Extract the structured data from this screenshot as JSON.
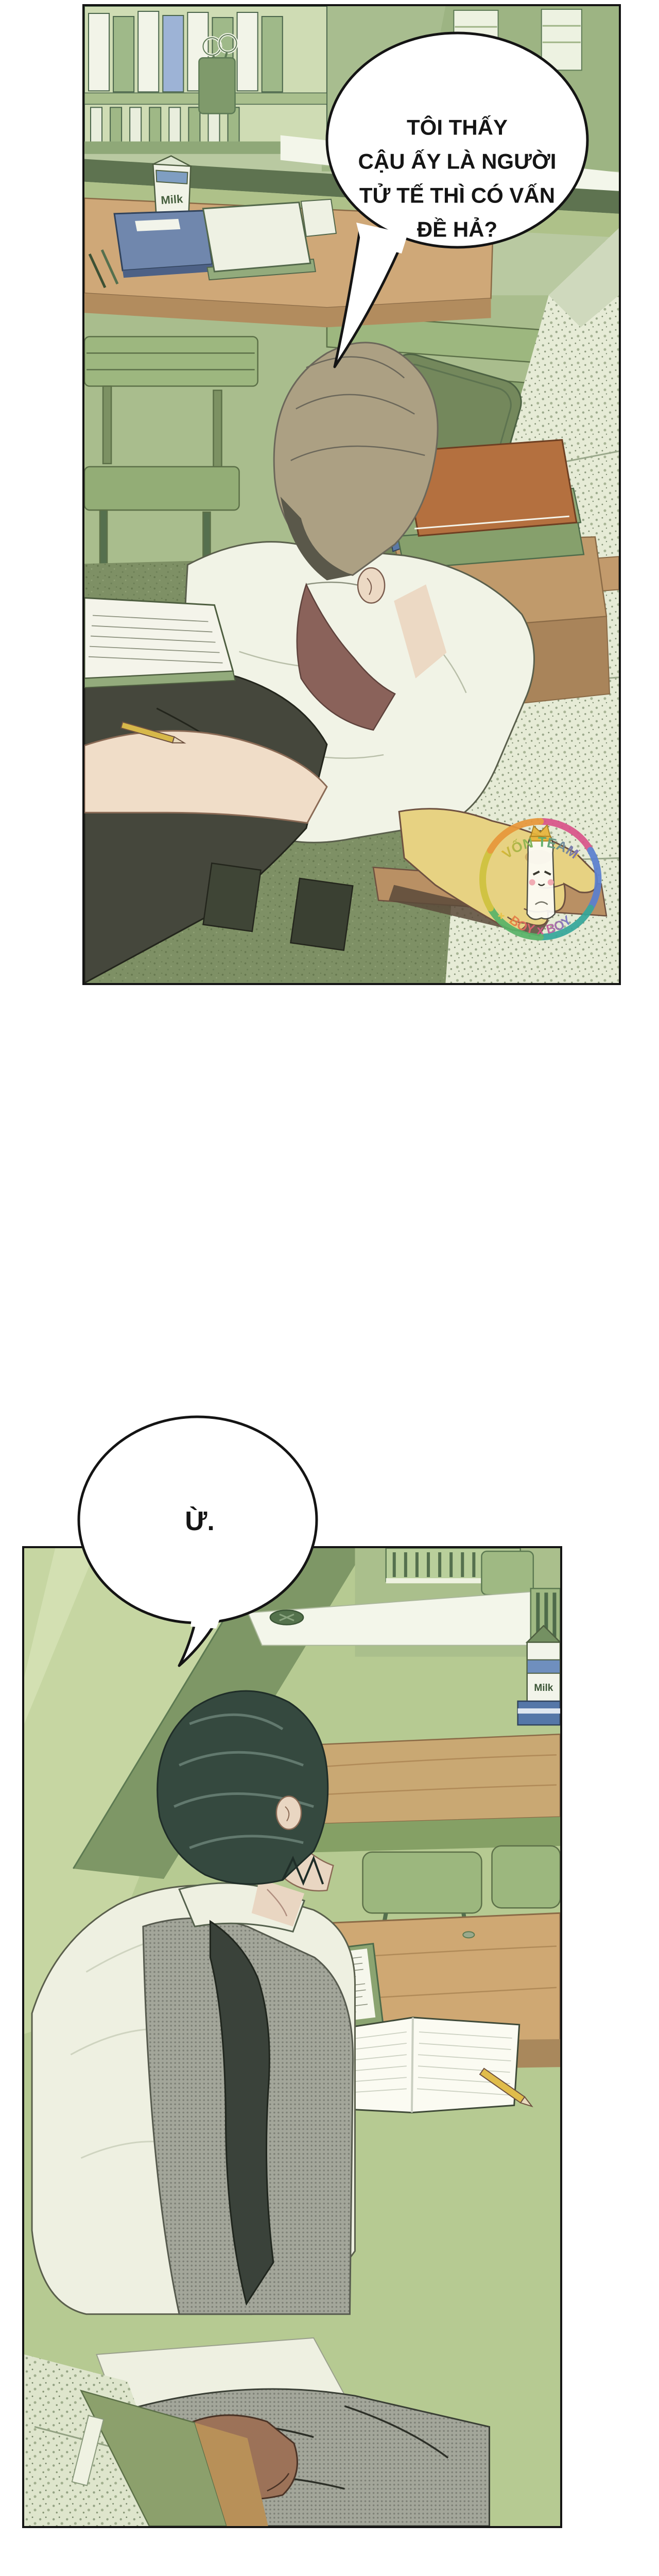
{
  "page": {
    "type": "webtoon-comic-page",
    "background": "#ffffff"
  },
  "panel1": {
    "alt": "Green-toned classroom seen from above: bookshelf and counter at back, desks with milk carton and notebooks, a light-haired student in a white shirt sits sideways at a bench, head lowered, one hand resting on the bench; stack of books (orange, green, blue) on a desk; speckled granite floor at right.",
    "bubble": {
      "lines": [
        "TÔI THẤY",
        "CẬU ẤY LÀ NGƯỜI",
        "TỬ TẾ THÌ CÓ VẤN",
        "ĐỀ HẢ?"
      ]
    },
    "milk_label": "Milk"
  },
  "panel2": {
    "alt": "Green-toned classroom: back wall with diagonal light, cabinet with vents and white counter at top right, milk carton at edge, a dark-haired student in a white shirt with dark tie and grey halftone vest sits at a desk with an open lined notebook, green handout booklet and a yellow pencil.",
    "bubble": {
      "text": "Ừ."
    },
    "milk_label": "Milk"
  },
  "watermark": {
    "top": "VỐN TEAM",
    "bottom": "BOY x BOY"
  },
  "colors": {
    "panel_border": "#141414",
    "bubble_fill": "#ffffff",
    "bubble_stroke": "#141414",
    "green_wall": "#b9c9a1",
    "dark_band": "#5e7350",
    "desk_tan": "#cfa873",
    "granite_floor": "#e6ebd6",
    "moss_floor": "#7e9065",
    "hair_light": "#aca083",
    "hair_dark": "#35493f",
    "skin": "#ecd9c4",
    "shirt_white": "#f1f3e6",
    "arm_lit_yellow": "#e7d282",
    "book_orange": "#b4703f",
    "book_blue": "#5b79a6",
    "milk_blue": "#7f9ec2",
    "watermark_gold": "#e8b43a"
  }
}
